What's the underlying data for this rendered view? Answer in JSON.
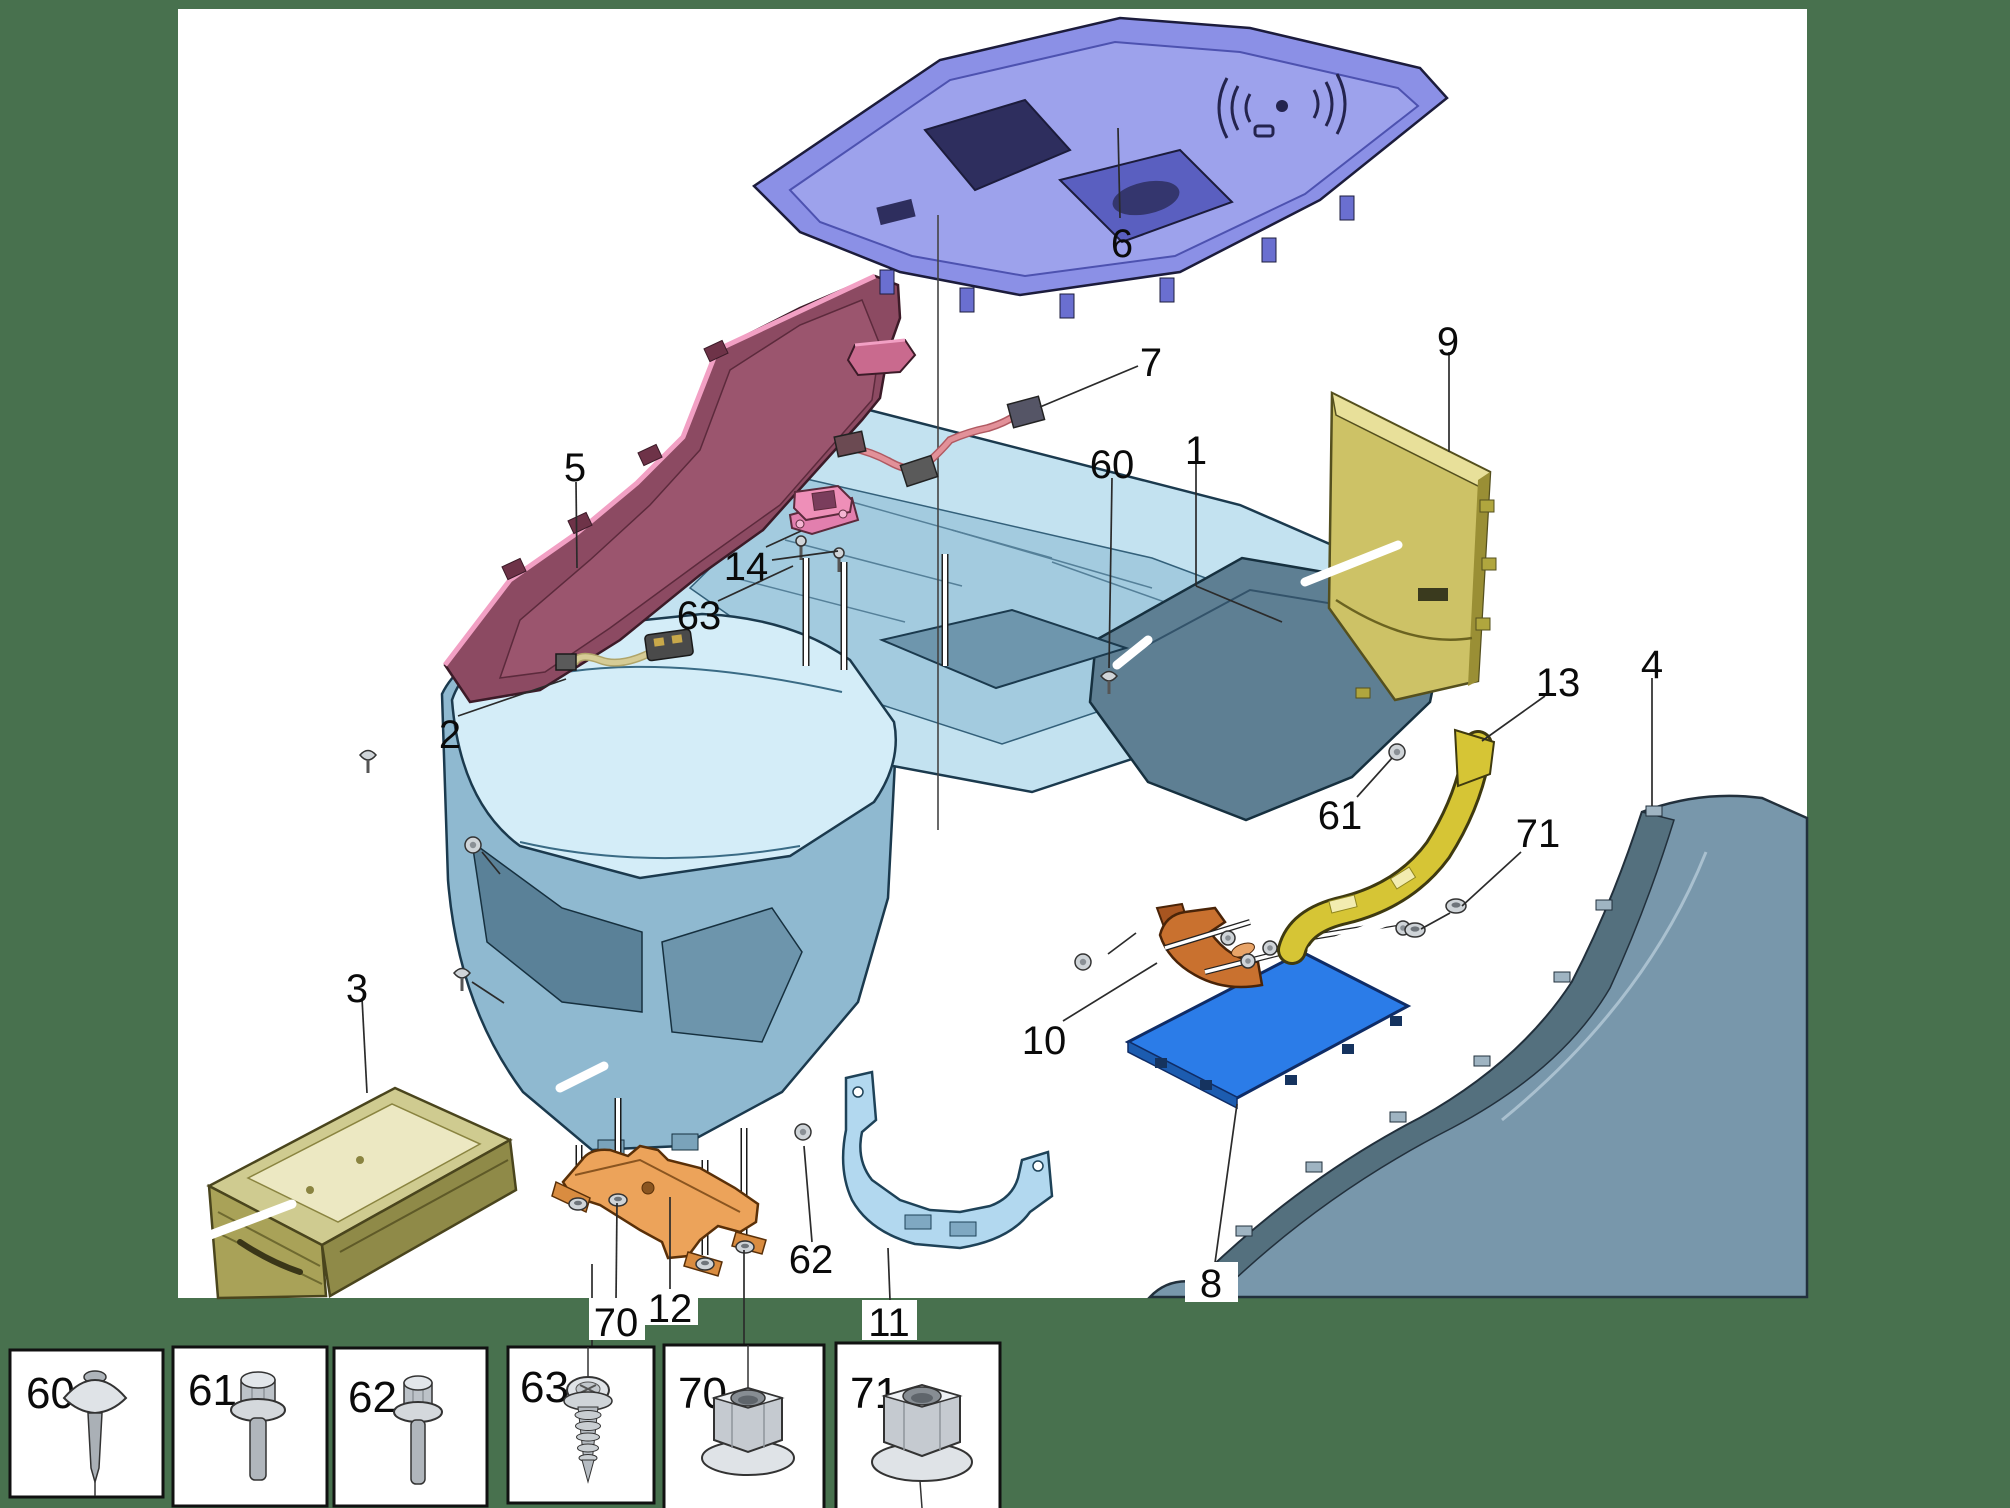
{
  "page": {
    "kind": "exploded-parts-diagram",
    "subject": "center-console-assembly",
    "background_color": "#48714e",
    "canvas_color": "#ffffff"
  },
  "callouts": [
    {
      "label": "1"
    },
    {
      "label": "2"
    },
    {
      "label": "3"
    },
    {
      "label": "4"
    },
    {
      "label": "5"
    },
    {
      "label": "6"
    },
    {
      "label": "7"
    },
    {
      "label": "8"
    },
    {
      "label": "9"
    },
    {
      "label": "10"
    },
    {
      "label": "11"
    },
    {
      "label": "12"
    },
    {
      "label": "13"
    },
    {
      "label": "14"
    },
    {
      "label": "60"
    },
    {
      "label": "61"
    },
    {
      "label": "62"
    },
    {
      "label": "63"
    },
    {
      "label": "70"
    },
    {
      "label": "71"
    }
  ],
  "legend": {
    "items": [
      {
        "label": "60",
        "fastener": "push-pin-screw"
      },
      {
        "label": "61",
        "fastener": "hex-washer-bolt"
      },
      {
        "label": "62",
        "fastener": "hex-washer-bolt-small"
      },
      {
        "label": "63",
        "fastener": "pan-head-tapping-screw"
      },
      {
        "label": "70",
        "fastener": "hex-flange-nut"
      },
      {
        "label": "71",
        "fastener": "hex-flange-nut-large"
      }
    ]
  },
  "part_colors": {
    "console_body_1": "#c3e2f0",
    "console_rear_1": "#5e7f93",
    "harness_2": "#d6cc96",
    "storage_bin_3": "#a9a258",
    "side_panel_4": "#7897ab",
    "side_panel_5": "#8c4a62",
    "top_panel_6": "#8b90e6",
    "wiring_7": "#e29199",
    "floor_panel_8": "#2b7ce8",
    "rear_panel_9": "#cdc266",
    "hook_bracket_10": "#c9712f",
    "support_bracket_11": "#b2d8ef",
    "bracket_12": "#eca35a",
    "bracket_13": "#d6c535",
    "latch_14": "#ee8fb8",
    "fastener_gray": "#c9cdd2"
  }
}
